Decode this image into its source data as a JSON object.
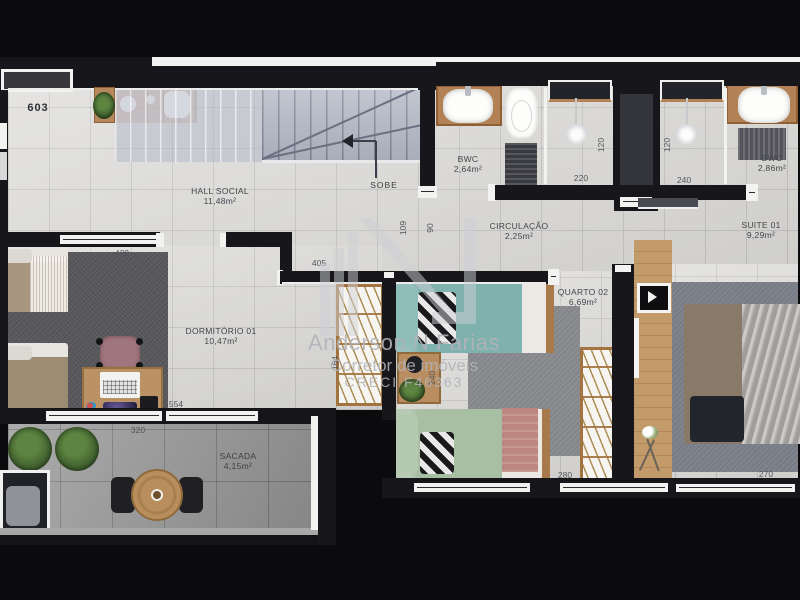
{
  "plan": {
    "unit_number": "603",
    "stairs": {
      "label": "SOBE"
    },
    "rooms": {
      "hall": {
        "name": "HALL SOCIAL",
        "area": "11,48m²"
      },
      "bwc1": {
        "name": "BWC",
        "area": "2,64m²"
      },
      "bwc2": {
        "name": "BWC",
        "area": "2,86m²"
      },
      "circulacao": {
        "name": "CIRCULAÇÃO",
        "area": "2,25m²"
      },
      "suite": {
        "name": "SUITE 01",
        "area": "9,29m²"
      },
      "dormitorio": {
        "name": "DORMITÓRIO 01",
        "area": "10,47m²"
      },
      "quarto2": {
        "name": "QUARTO 02",
        "area": "6,69m²"
      },
      "sacada": {
        "name": "SACADA",
        "area": "4,15m²"
      }
    },
    "dimensions": {
      "dorm_top": "429",
      "dorm_side": "554",
      "quarto_top": "405",
      "quarto_bottom": "280",
      "suite_bottom": "270",
      "sacada_width": "320",
      "closet_width": "164",
      "bedside_depth": "240",
      "shower1_width": "220",
      "shower1_depth": "120",
      "shower2_width": "240",
      "shower2_depth": "120",
      "circ_a": "109",
      "circ_b": "90"
    },
    "watermark": {
      "name": "Anderson N Farias",
      "role": "Corretor de imóveis",
      "license": "CRECI F46363"
    },
    "colors": {
      "wall": "#17171b",
      "frame_white": "#f2f2f0",
      "floor_tile": "#dcdbd8",
      "balcony_tile": "#9d9d9d",
      "stairs_slate": "#b5bbc8",
      "wood": "#c39b6b",
      "teal_bed": "#7fb1ae",
      "green_bed": "#a8bfa4",
      "pink_throw": "#bd8780",
      "tan_bed": "#9c8c74",
      "rug_dark": "#57575b",
      "rug_mid": "#898a8e",
      "watermark_gray": "#b2b3b9"
    }
  }
}
